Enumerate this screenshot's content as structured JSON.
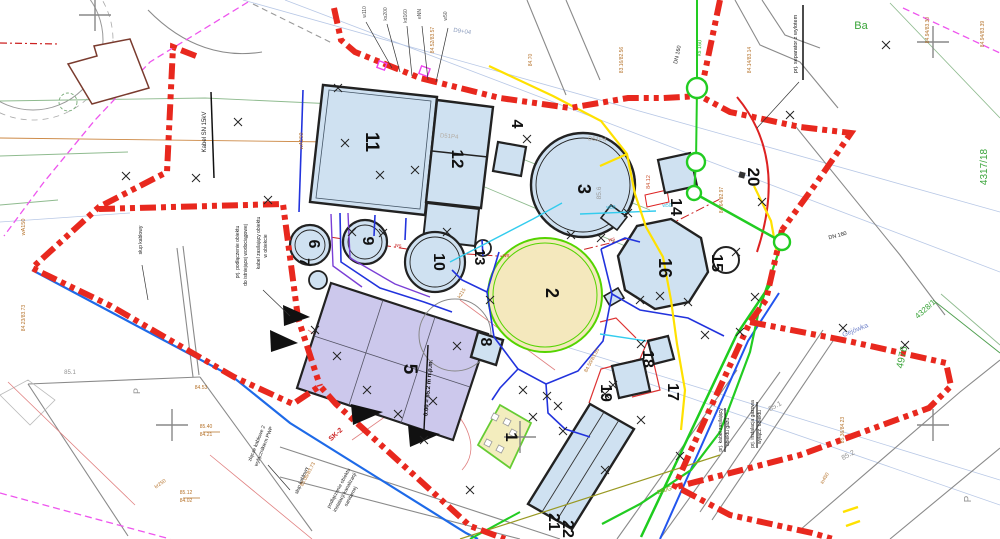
{
  "drawing_title": "Projekt zagospodarowania terenu - oczyszczalnia",
  "structures": [
    {
      "id": "1",
      "x": 506,
      "y": 437,
      "r": 90,
      "s": 17
    },
    {
      "id": "2",
      "x": 546,
      "y": 293,
      "r": 90,
      "s": 18
    },
    {
      "id": "3",
      "x": 578,
      "y": 189,
      "r": 90,
      "s": 18
    },
    {
      "id": "4",
      "x": 512,
      "y": 124,
      "r": 90,
      "s": 16
    },
    {
      "id": "5",
      "x": 404,
      "y": 369,
      "r": 90,
      "s": 19
    },
    {
      "id": "6",
      "x": 309,
      "y": 244,
      "r": 90,
      "s": 16
    },
    {
      "id": "7",
      "x": 300,
      "y": 262,
      "r": 90,
      "s": 14
    },
    {
      "id": "8",
      "x": 481,
      "y": 342,
      "r": 90,
      "s": 16
    },
    {
      "id": "9",
      "x": 363,
      "y": 241,
      "r": 90,
      "s": 16
    },
    {
      "id": "10",
      "x": 434,
      "y": 262,
      "r": 90,
      "s": 16
    },
    {
      "id": "11",
      "x": 366,
      "y": 142,
      "r": 90,
      "s": 19
    },
    {
      "id": "12",
      "x": 452,
      "y": 159,
      "r": 90,
      "s": 17
    },
    {
      "id": "13",
      "x": 475,
      "y": 257,
      "r": 90,
      "s": 15
    },
    {
      "id": "14",
      "x": 671,
      "y": 207,
      "r": 90,
      "s": 16
    },
    {
      "id": "15",
      "x": 712,
      "y": 263,
      "r": 90,
      "s": 16
    },
    {
      "id": "16",
      "x": 659,
      "y": 268,
      "r": 90,
      "s": 18
    },
    {
      "id": "17",
      "x": 668,
      "y": 392,
      "r": 90,
      "s": 16
    },
    {
      "id": "18",
      "x": 643,
      "y": 359,
      "r": 90,
      "s": 16
    },
    {
      "id": "19",
      "x": 601,
      "y": 393,
      "r": 90,
      "s": 16
    },
    {
      "id": "20",
      "x": 748,
      "y": 177,
      "r": 90,
      "s": 17
    },
    {
      "id": "21",
      "x": 549,
      "y": 522,
      "r": 90,
      "s": 16
    },
    {
      "id": "22",
      "x": 563,
      "y": 529,
      "r": 90,
      "s": 16
    }
  ],
  "annotations": [
    {
      "t": "SK-2",
      "x": 337,
      "y": 436,
      "r": -42,
      "s": 7,
      "c": "#cc2222",
      "w": "700"
    },
    {
      "t": "Kabel SN 15kV",
      "x": 206,
      "y": 132,
      "r": -90,
      "s": 6,
      "c": "#222222"
    },
    {
      "t": "prj. separator z wylotem",
      "x": 797,
      "y": 44,
      "r": -90,
      "s": 5.5,
      "c": "#222222"
    },
    {
      "t": "słup kablowy",
      "x": 142,
      "y": 240,
      "r": -90,
      "s": 5,
      "c": "#222222"
    },
    {
      "t": "prj. podłączenie obiektu",
      "x": 239,
      "y": 252,
      "r": -90,
      "s": 5,
      "c": "#222222"
    },
    {
      "t": "do istniejącej wodociągowej",
      "x": 247,
      "y": 255,
      "r": -90,
      "s": 5,
      "c": "#222222"
    },
    {
      "t": "kabel zasilający obiektu",
      "x": 260,
      "y": 243,
      "r": -90,
      "s": 5,
      "c": "#222222"
    },
    {
      "t": "w obiekcie",
      "x": 267,
      "y": 246,
      "r": -90,
      "s": 5,
      "c": "#222222"
    },
    {
      "t": "podłączenie obiektu",
      "x": 340,
      "y": 489,
      "r": -62,
      "s": 5,
      "c": "#222222"
    },
    {
      "t": "instalacji kanalizacji",
      "x": 346,
      "y": 493,
      "r": -62,
      "s": 5,
      "c": "#222222"
    },
    {
      "t": "sanitarnej",
      "x": 352,
      "y": 497,
      "r": -62,
      "s": 5,
      "c": "#222222"
    },
    {
      "t": "złącze kablowe 2",
      "x": 258,
      "y": 444,
      "r": -68,
      "s": 5,
      "c": "#222222"
    },
    {
      "t": "wyłącznikiem PWP",
      "x": 265,
      "y": 447,
      "r": -68,
      "s": 5,
      "c": "#222222"
    },
    {
      "t": "słup kablowy",
      "x": 303,
      "y": 481,
      "r": -68,
      "s": 5,
      "c": "#222222"
    },
    {
      "t": "prj. kabel zasilający",
      "x": 722,
      "y": 430,
      "r": -90,
      "s": 5,
      "c": "#222222"
    },
    {
      "t": "obiektu gazu",
      "x": 729,
      "y": 432,
      "r": -90,
      "s": 5,
      "c": "#222222"
    },
    {
      "t": "prj. instalacja gazowa",
      "x": 754,
      "y": 424,
      "r": -90,
      "s": 5,
      "c": "#222222"
    },
    {
      "t": "wyłącz. obiektu",
      "x": 761,
      "y": 427,
      "r": -90,
      "s": 5,
      "c": "#222222"
    },
    {
      "t": "DN 160",
      "x": 679,
      "y": 55,
      "r": -78,
      "s": 5.5,
      "c": "#222222"
    },
    {
      "t": "DN 160",
      "x": 838,
      "y": 237,
      "r": -15,
      "s": 5.5,
      "c": "#222222"
    },
    {
      "t": "0.00 = 85.2 m n.p.m.",
      "x": 430,
      "y": 388,
      "r": -85,
      "s": 6,
      "c": "#111111",
      "w": "700"
    },
    {
      "t": "w110",
      "x": 366,
      "y": 12,
      "r": -90,
      "s": 5,
      "c": "#555555"
    },
    {
      "t": "ks200",
      "x": 387,
      "y": 14,
      "r": -90,
      "s": 5,
      "c": "#555555"
    },
    {
      "t": "kd160",
      "x": 407,
      "y": 16,
      "r": -90,
      "s": 5,
      "c": "#555555"
    },
    {
      "t": "eNN",
      "x": 421,
      "y": 14,
      "r": -90,
      "s": 5,
      "c": "#555555"
    },
    {
      "t": "w50",
      "x": 447,
      "y": 16,
      "r": -90,
      "s": 5,
      "c": "#555555"
    },
    {
      "t": "Ba",
      "x": 861,
      "y": 29,
      "r": 0,
      "s": 11,
      "c": "#3aa43a"
    },
    {
      "t": "4317/18",
      "x": 987,
      "y": 167,
      "r": -90,
      "s": 10,
      "c": "#3aa43a"
    },
    {
      "t": "4976",
      "x": 905,
      "y": 358,
      "r": -78,
      "s": 10,
      "c": "#3aa43a"
    },
    {
      "t": "4328/1",
      "x": 927,
      "y": 311,
      "r": -42,
      "s": 8,
      "c": "#3aa43a"
    },
    {
      "t": "ks 160",
      "x": 701,
      "y": 48,
      "r": -87,
      "s": 5.5,
      "c": "#2bb52b"
    },
    {
      "t": "DN/G",
      "x": 665,
      "y": 492,
      "r": -18,
      "s": 6,
      "c": "#999922"
    },
    {
      "t": "85.1",
      "x": 776,
      "y": 408,
      "r": -28,
      "s": 7,
      "c": "#909090"
    },
    {
      "t": "85.2",
      "x": 849,
      "y": 457,
      "r": -28,
      "s": 7,
      "c": "#909090"
    },
    {
      "t": "85.1",
      "x": 70,
      "y": 374,
      "r": 0,
      "s": 6,
      "c": "#909090"
    },
    {
      "t": "85.6",
      "x": 601,
      "y": 193,
      "r": -90,
      "s": 6.5,
      "c": "#9a9a9a"
    },
    {
      "t": "P",
      "x": 971,
      "y": 499,
      "r": -90,
      "s": 10,
      "c": "#909090"
    },
    {
      "t": "P",
      "x": 140,
      "y": 391,
      "r": -90,
      "s": 9,
      "c": "#909090"
    },
    {
      "t": "D51P4",
      "x": 449,
      "y": 138,
      "r": 5,
      "s": 6,
      "c": "#b3aba2"
    },
    {
      "t": "D51P4",
      "x": 597,
      "y": 141,
      "r": 5,
      "s": 6,
      "c": "#b3aba2"
    },
    {
      "t": "D9+04",
      "x": 462,
      "y": 33,
      "r": 8,
      "s": 6,
      "c": "#8899bb"
    },
    {
      "t": "ws",
      "x": 398,
      "y": 247,
      "r": 6,
      "s": 5.5,
      "c": "#cc3333"
    },
    {
      "t": "ws",
      "x": 506,
      "y": 257,
      "r": 2,
      "s": 5.5,
      "c": "#cc3333"
    },
    {
      "t": "ws",
      "x": 612,
      "y": 241,
      "r": -12,
      "s": 5.5,
      "c": "#cc3333"
    },
    {
      "t": "wA150",
      "x": 25,
      "y": 227,
      "r": -90,
      "s": 5.5,
      "c": "#b5722a"
    },
    {
      "t": "wA150",
      "x": 303,
      "y": 141,
      "r": -90,
      "s": 5.5,
      "c": "#b5722a"
    },
    {
      "t": "83.16/82.56",
      "x": 623,
      "y": 60,
      "r": -90,
      "s": 5,
      "c": "#b5722a"
    },
    {
      "t": "84.94/83.30",
      "x": 929,
      "y": 30,
      "r": -90,
      "s": 5,
      "c": "#b5722a"
    },
    {
      "t": "84.94/83.39",
      "x": 984,
      "y": 34,
      "r": -90,
      "s": 5,
      "c": "#b5722a"
    },
    {
      "t": "84.14/83.14",
      "x": 751,
      "y": 60,
      "r": -90,
      "s": 5,
      "c": "#b5722a"
    },
    {
      "t": "84.64/82.97",
      "x": 723,
      "y": 200,
      "r": -90,
      "s": 5,
      "c": "#b5722a"
    },
    {
      "t": "84.52/83.57",
      "x": 434,
      "y": 40,
      "r": -90,
      "s": 5,
      "c": "#b5722a"
    },
    {
      "t": "84.70",
      "x": 532,
      "y": 60,
      "r": -90,
      "s": 5,
      "c": "#b5722a"
    },
    {
      "t": "85.36/84.23",
      "x": 844,
      "y": 430,
      "r": -90,
      "s": 5,
      "c": "#b5722a"
    },
    {
      "t": "84.23/83.73",
      "x": 25,
      "y": 318,
      "r": -90,
      "s": 5,
      "c": "#b5722a"
    },
    {
      "t": "85.05/83.73",
      "x": 309,
      "y": 475,
      "r": -62,
      "s": 5,
      "c": "#b5722a"
    },
    {
      "t": "84.50/83.55",
      "x": 593,
      "y": 361,
      "r": -62,
      "s": 5,
      "c": "#b5722a"
    },
    {
      "t": "84.53",
      "x": 201,
      "y": 389,
      "r": 0,
      "s": 5,
      "c": "#b5722a"
    },
    {
      "t": "85.40",
      "x": 206,
      "y": 428,
      "r": 0,
      "s": 5,
      "c": "#b5722a"
    },
    {
      "t": "84.21",
      "x": 206,
      "y": 436,
      "r": 0,
      "s": 5,
      "c": "#b5722a"
    },
    {
      "t": "85.12",
      "x": 186,
      "y": 494,
      "r": 0,
      "s": 5,
      "c": "#b5722a"
    },
    {
      "t": "84.02",
      "x": 186,
      "y": 502,
      "r": 0,
      "s": 5,
      "c": "#b5722a"
    },
    {
      "t": "k215",
      "x": 463,
      "y": 294,
      "r": -58,
      "s": 5,
      "c": "#b5722a"
    },
    {
      "t": "kr250",
      "x": 161,
      "y": 485,
      "r": -35,
      "s": 5,
      "c": "#b5722a"
    },
    {
      "t": "in450",
      "x": 826,
      "y": 479,
      "r": -60,
      "s": 5,
      "c": "#b5722a"
    },
    {
      "t": "84.12",
      "x": 650,
      "y": 182,
      "r": -90,
      "s": 5.5,
      "c": "#cc5533"
    },
    {
      "t": "w50",
      "x": 611,
      "y": 209,
      "r": 0,
      "s": 5,
      "c": "#33bbdd"
    },
    {
      "t": "w50",
      "x": 667,
      "y": 207,
      "r": 0,
      "s": 5,
      "c": "#33bbdd"
    },
    {
      "t": "Gejówka",
      "x": 856,
      "y": 332,
      "r": -22,
      "s": 7,
      "c": "#7788cc"
    }
  ],
  "crosses": [
    [
      126,
      176
    ],
    [
      196,
      178
    ],
    [
      238,
      122
    ],
    [
      338,
      88
    ],
    [
      345,
      143
    ],
    [
      380,
      175
    ],
    [
      415,
      170
    ],
    [
      352,
      232
    ],
    [
      383,
      233
    ],
    [
      447,
      232
    ],
    [
      527,
      139
    ],
    [
      571,
      235
    ],
    [
      601,
      238
    ],
    [
      628,
      213
    ],
    [
      886,
      45
    ],
    [
      790,
      115
    ],
    [
      268,
      200
    ],
    [
      640,
      300
    ],
    [
      660,
      296
    ],
    [
      688,
      302
    ],
    [
      641,
      344
    ],
    [
      705,
      335
    ],
    [
      755,
      297
    ],
    [
      740,
      332
    ],
    [
      762,
      202
    ],
    [
      736,
      252
    ],
    [
      315,
      330
    ],
    [
      337,
      356
    ],
    [
      367,
      390
    ],
    [
      398,
      414
    ],
    [
      424,
      440
    ],
    [
      433,
      401
    ],
    [
      457,
      346
    ],
    [
      490,
      300
    ],
    [
      523,
      390
    ],
    [
      547,
      396
    ],
    [
      558,
      406
    ],
    [
      533,
      417
    ],
    [
      563,
      431
    ],
    [
      605,
      394
    ],
    [
      613,
      385
    ],
    [
      641,
      420
    ],
    [
      680,
      456
    ],
    [
      605,
      470
    ],
    [
      470,
      490
    ],
    [
      843,
      328
    ],
    [
      905,
      345
    ]
  ],
  "big_crosses": [
    [
      933,
      42
    ],
    [
      933,
      425
    ],
    [
      172,
      425
    ],
    [
      95,
      15
    ],
    [
      520,
      437
    ]
  ],
  "manholes": [
    [
      697,
      88,
      10
    ],
    [
      696,
      162,
      9
    ],
    [
      694,
      193,
      7
    ],
    [
      782,
      242,
      8
    ]
  ],
  "colors": {
    "boundary": "#e8281e",
    "building_fill": "#cfe1f1",
    "building5_fill": "#ccc8ec",
    "tank2_fill": "#f4e8bd",
    "tank2_ring": "#55d400",
    "b1_fill": "#f3edbe",
    "b1_ring": "#66cc33",
    "green_utility": "#22cc22",
    "yellow_utility": "#ffe100",
    "blue_utility": "#2233dd",
    "cyan_utility": "#33ccee",
    "magenta": "#ee55ee",
    "contour": "#8fbb8f",
    "orange_line": "#cc8844"
  }
}
